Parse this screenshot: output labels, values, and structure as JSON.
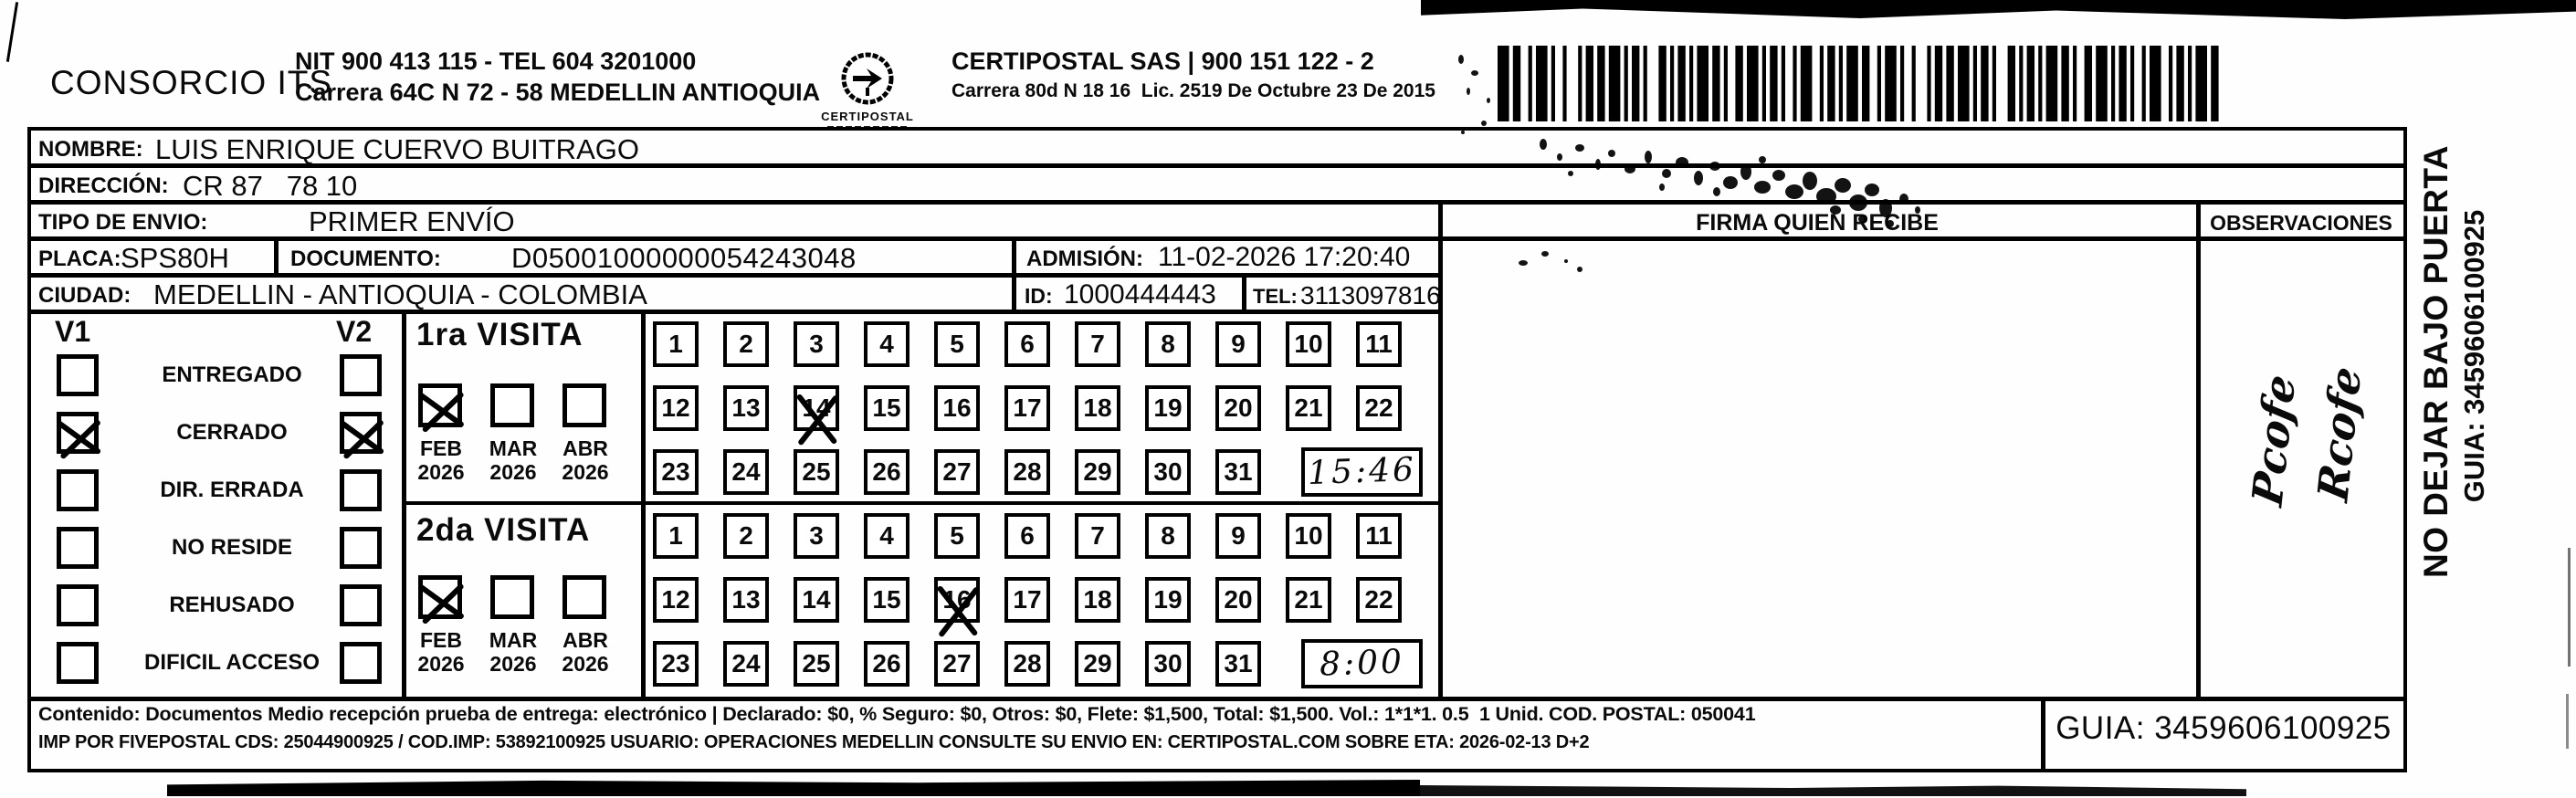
{
  "header": {
    "company": "CONSORCIO ITS",
    "nit_line": "NIT 900 413 115 - TEL 604 3201000",
    "address_line": "Carrera 64C N 72 - 58 MEDELLIN ANTIOQUIA",
    "logo_caption": "CERTIPOSTAL",
    "provider_line1": "CERTIPOSTAL SAS | 900 151 122 - 2",
    "provider_line2": "Carrera 80d N 18 16  Lic. 2519 De Octubre 23 De 2015"
  },
  "recipient": {
    "nombre_label": "NOMBRE:",
    "nombre": "LUIS ENRIQUE CUERVO BUITRAGO",
    "direccion_label": "DIRECCIÓN:",
    "direccion": "CR 87   78 10",
    "tipo_envio_label": "TIPO DE ENVIO:",
    "tipo_envio": "PRIMER ENVÍO",
    "placa_label": "PLACA:",
    "placa": "SPS80H",
    "documento_label": "DOCUMENTO:",
    "documento": "D05001000000054243048",
    "admision_label": "ADMISIÓN:",
    "admision": "11-02-2026 17:20:40",
    "ciudad_label": "CIUDAD:",
    "ciudad": "MEDELLIN - ANTIOQUIA - COLOMBIA",
    "id_label": "ID:",
    "id": "1000444443",
    "tel_label": "TEL:",
    "tel": "3113097816"
  },
  "firma": {
    "header": "FIRMA QUIEN RECIBE"
  },
  "observaciones": {
    "header": "OBSERVACIONES",
    "note_line1": "Pcofe",
    "note_line2": "Rcofe"
  },
  "status": {
    "v1_label": "V1",
    "v2_label": "V2",
    "items": [
      {
        "label": "ENTREGADO",
        "v1_checked": false,
        "v2_checked": false
      },
      {
        "label": "CERRADO",
        "v1_checked": true,
        "v2_checked": true
      },
      {
        "label": "DIR. ERRADA",
        "v1_checked": false,
        "v2_checked": false
      },
      {
        "label": "NO RESIDE",
        "v1_checked": false,
        "v2_checked": false
      },
      {
        "label": "REHUSADO",
        "v1_checked": false,
        "v2_checked": false
      },
      {
        "label": "DIFICIL ACCESO",
        "v1_checked": false,
        "v2_checked": false
      }
    ]
  },
  "visits": [
    {
      "title": "1ra VISITA",
      "months": [
        {
          "month": "FEB",
          "year": "2026",
          "checked": true
        },
        {
          "month": "MAR",
          "year": "2026",
          "checked": false
        },
        {
          "month": "ABR",
          "year": "2026",
          "checked": false
        }
      ],
      "day_rows": [
        [
          "1",
          "2",
          "3",
          "4",
          "5",
          "6",
          "7",
          "8",
          "9",
          "10",
          "11"
        ],
        [
          "12",
          "13",
          "14",
          "15",
          "16",
          "17",
          "18",
          "19",
          "20",
          "21",
          "22"
        ],
        [
          "23",
          "24",
          "25",
          "26",
          "27",
          "28",
          "29",
          "30",
          "31"
        ]
      ],
      "crossed_days": [
        "14"
      ],
      "handwritten_time": "15:46"
    },
    {
      "title": "2da VISITA",
      "months": [
        {
          "month": "FEB",
          "year": "2026",
          "checked": true
        },
        {
          "month": "MAR",
          "year": "2026",
          "checked": false
        },
        {
          "month": "ABR",
          "year": "2026",
          "checked": false
        }
      ],
      "day_rows": [
        [
          "1",
          "2",
          "3",
          "4",
          "5",
          "6",
          "7",
          "8",
          "9",
          "10",
          "11"
        ],
        [
          "12",
          "13",
          "14",
          "15",
          "16",
          "17",
          "18",
          "19",
          "20",
          "21",
          "22"
        ],
        [
          "23",
          "24",
          "25",
          "26",
          "27",
          "28",
          "29",
          "30",
          "31"
        ]
      ],
      "crossed_days": [
        "16"
      ],
      "handwritten_time": "8:00"
    }
  ],
  "footer": {
    "line1": "Contenido: Documentos Medio recepción prueba de entrega: electrónico | Declarado: $0, % Seguro: $0, Otros: $0, Flete: $1,500, Total: $1,500. Vol.: 1*1*1. 0.5  1 Unid. COD. POSTAL: 050041",
    "line2": "IMP POR FIVEPOSTAL CDS: 25044900925 / COD.IMP: 53892100925 USUARIO: OPERACIONES MEDELLIN CONSULTE SU ENVIO EN: CERTIPOSTAL.COM SOBRE ETA: 2026-02-13 D+2",
    "guia": "GUIA: 3459606100925"
  },
  "side": {
    "warning": "NO DEJAR BAJO PUERTA",
    "guia": "GUIA: 3459606100925"
  }
}
